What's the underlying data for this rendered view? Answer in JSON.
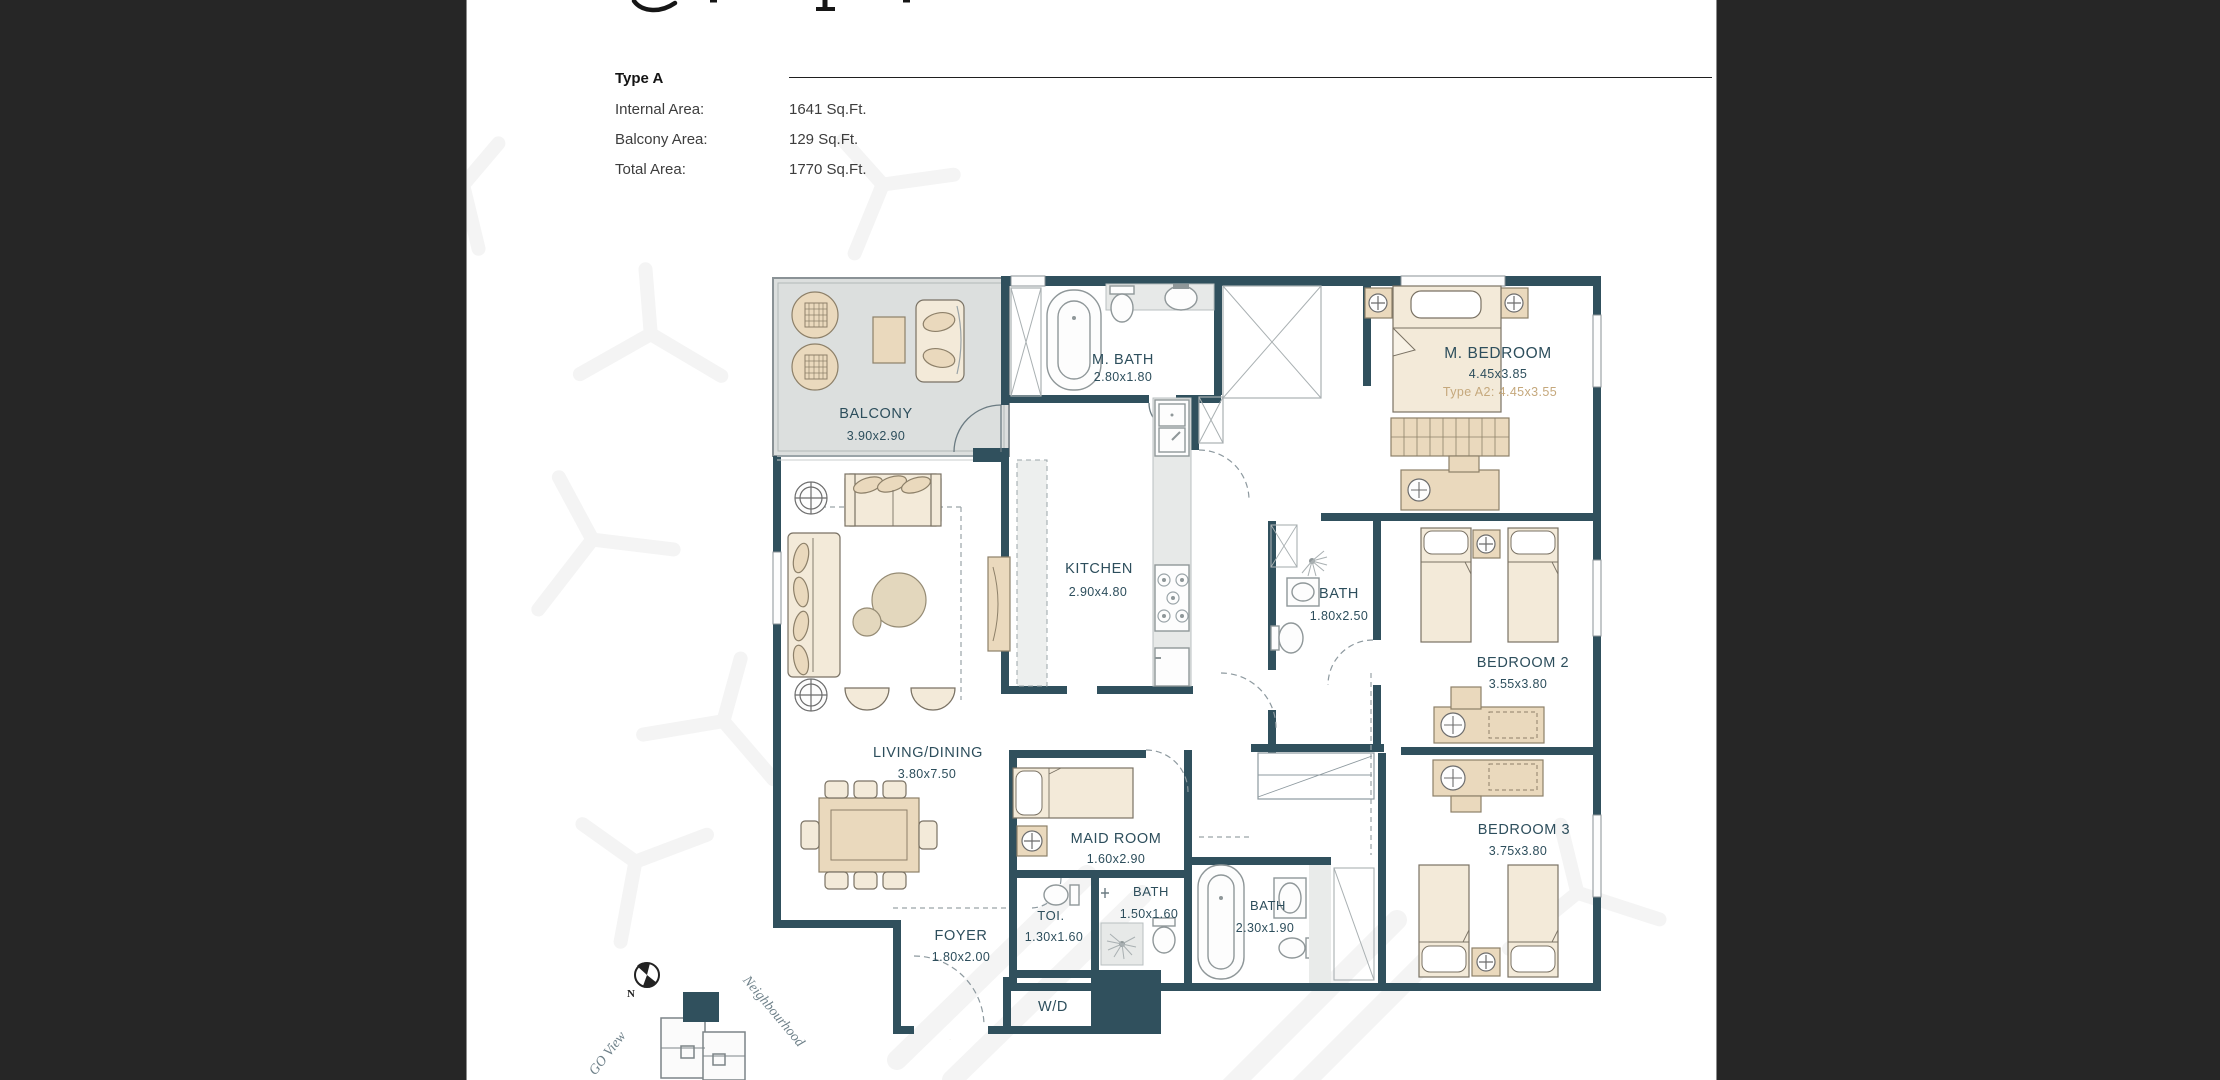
{
  "header": {
    "type_label": "Type A",
    "rows": [
      {
        "label": "Internal Area:",
        "value": "1641 Sq.Ft."
      },
      {
        "label": "Balcony Area:",
        "value": "129 Sq.Ft."
      },
      {
        "label": "Total Area:",
        "value": "1770 Sq.Ft."
      }
    ]
  },
  "plan": {
    "rooms": [
      {
        "name": "BALCONY",
        "dims": "3.90x2.90"
      },
      {
        "name": "M. BATH",
        "dims": "2.80x1.80"
      },
      {
        "name": "M. BEDROOM",
        "dims": "4.45x3.85",
        "alt": "Type A2: 4.45x3.55"
      },
      {
        "name": "KITCHEN",
        "dims": "2.90x4.80"
      },
      {
        "name": "BATH",
        "dims": "1.80x2.50"
      },
      {
        "name": "BEDROOM 2",
        "dims": "3.55x3.80"
      },
      {
        "name": "LIVING/DINING",
        "dims": "3.80x7.50"
      },
      {
        "name": "MAID ROOM",
        "dims": "1.60x2.90"
      },
      {
        "name": "TOI.",
        "dims": "1.30x1.60"
      },
      {
        "name": "BATH",
        "dims": "1.50x1.60"
      },
      {
        "name": "BATH",
        "dims": "2.30x1.90"
      },
      {
        "name": "FOYER",
        "dims": "1.80x2.00"
      },
      {
        "name": "W/D"
      },
      {
        "name": "BEDROOM 3",
        "dims": "3.75x3.80"
      }
    ],
    "compass_label": "N",
    "site_labels": {
      "left": "GO View",
      "right": "Neighbourhood"
    },
    "colors": {
      "wall": "#30505d",
      "room_text": "#2d4e5c",
      "furniture": "#ead9bd",
      "balcony_fill": "#dcdfde",
      "alt_dim_text": "#c5a87c",
      "entry_marker": "#8f7620",
      "viewer_background": "#262626"
    }
  }
}
